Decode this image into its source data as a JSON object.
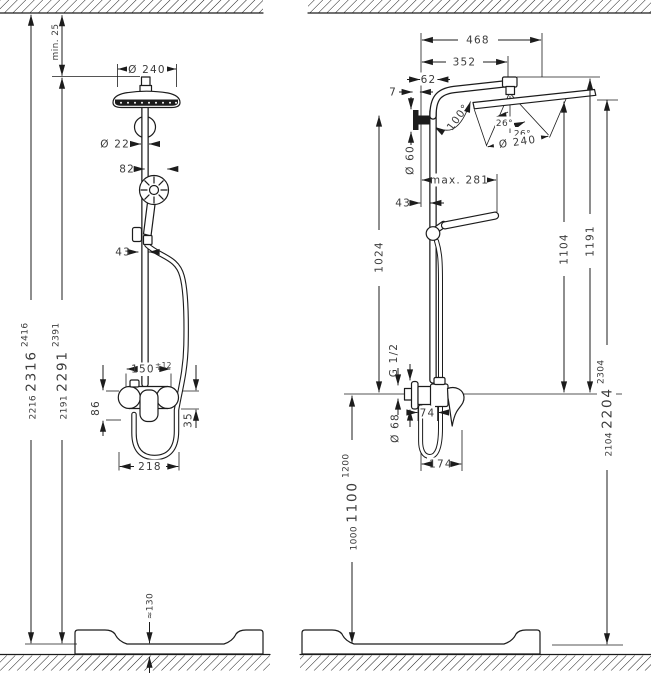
{
  "page": {
    "background": "#ffffff",
    "line_color": "#1c1c1c",
    "text_color": "#3b3b3b"
  },
  "front_view": {
    "dims": {
      "min_ceiling": "min. 25",
      "head_dia": "Ø 240",
      "pipe_dia": "Ø 22",
      "handshower_width": "82",
      "holder_offset": "43",
      "total_height": {
        "low": "2216",
        "mid": "2316",
        "high": "2416"
      },
      "unit_height": {
        "low": "2191",
        "mid": "2291",
        "high": "2391"
      },
      "connection_width": "150",
      "connection_tolerance": "±12",
      "mixer_height": "86",
      "lever_drop": "35",
      "mixer_width": "218",
      "tray_height": "≈130"
    }
  },
  "side_view": {
    "dims": {
      "overall_reach": "468",
      "arm_reach": "352",
      "wall_to_pipe_outer": "62",
      "wall_gap": "7",
      "arm_angle": "100°",
      "tilt_left": "26°",
      "tilt_right": "26°",
      "head_dia": "Ø 240",
      "bracket_dia": "Ø 60",
      "max_reach": "max. 281",
      "wall_to_pipe": "43",
      "bracket_height": "1024",
      "thread": "G 1/2",
      "escutcheon_dia": "Ø 68",
      "body_depth": "74",
      "overall_depth": "174",
      "head_face_height": "1104",
      "overall_height": "1191",
      "connection_height": {
        "low": "1000",
        "mid": "1100",
        "high": "1200"
      },
      "head_height": {
        "low": "2104",
        "mid": "2204",
        "high": "2304"
      }
    }
  }
}
